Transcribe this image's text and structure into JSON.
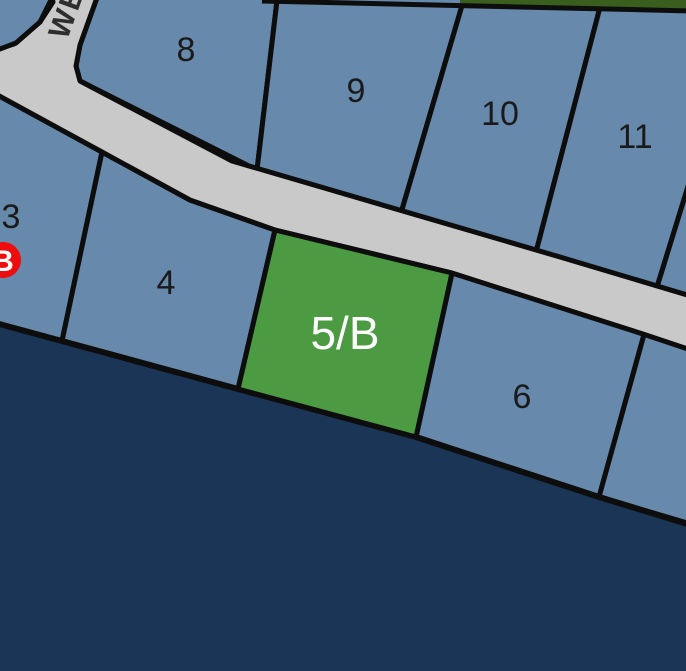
{
  "map": {
    "type": "waterfront-parcel-map",
    "road": {
      "label": "WE"
    },
    "parcels": {
      "highlighted": {
        "label": "5/B"
      },
      "items": [
        {
          "label": "3"
        },
        {
          "label": "4"
        },
        {
          "label": "6"
        },
        {
          "label": "8"
        },
        {
          "label": "9"
        },
        {
          "label": "10"
        },
        {
          "label": "11"
        }
      ]
    },
    "marker": {
      "label": "B"
    },
    "colors": {
      "parcel_blue": "#6789ab",
      "water_navy": "#1b3557",
      "road_gray": "#c9c9c9",
      "highlight_green": "#4c9b43",
      "vegetation_green": "#3a5e1e",
      "marker_red": "#ee0c0c",
      "boundary_black": "#0d0d0d"
    }
  }
}
